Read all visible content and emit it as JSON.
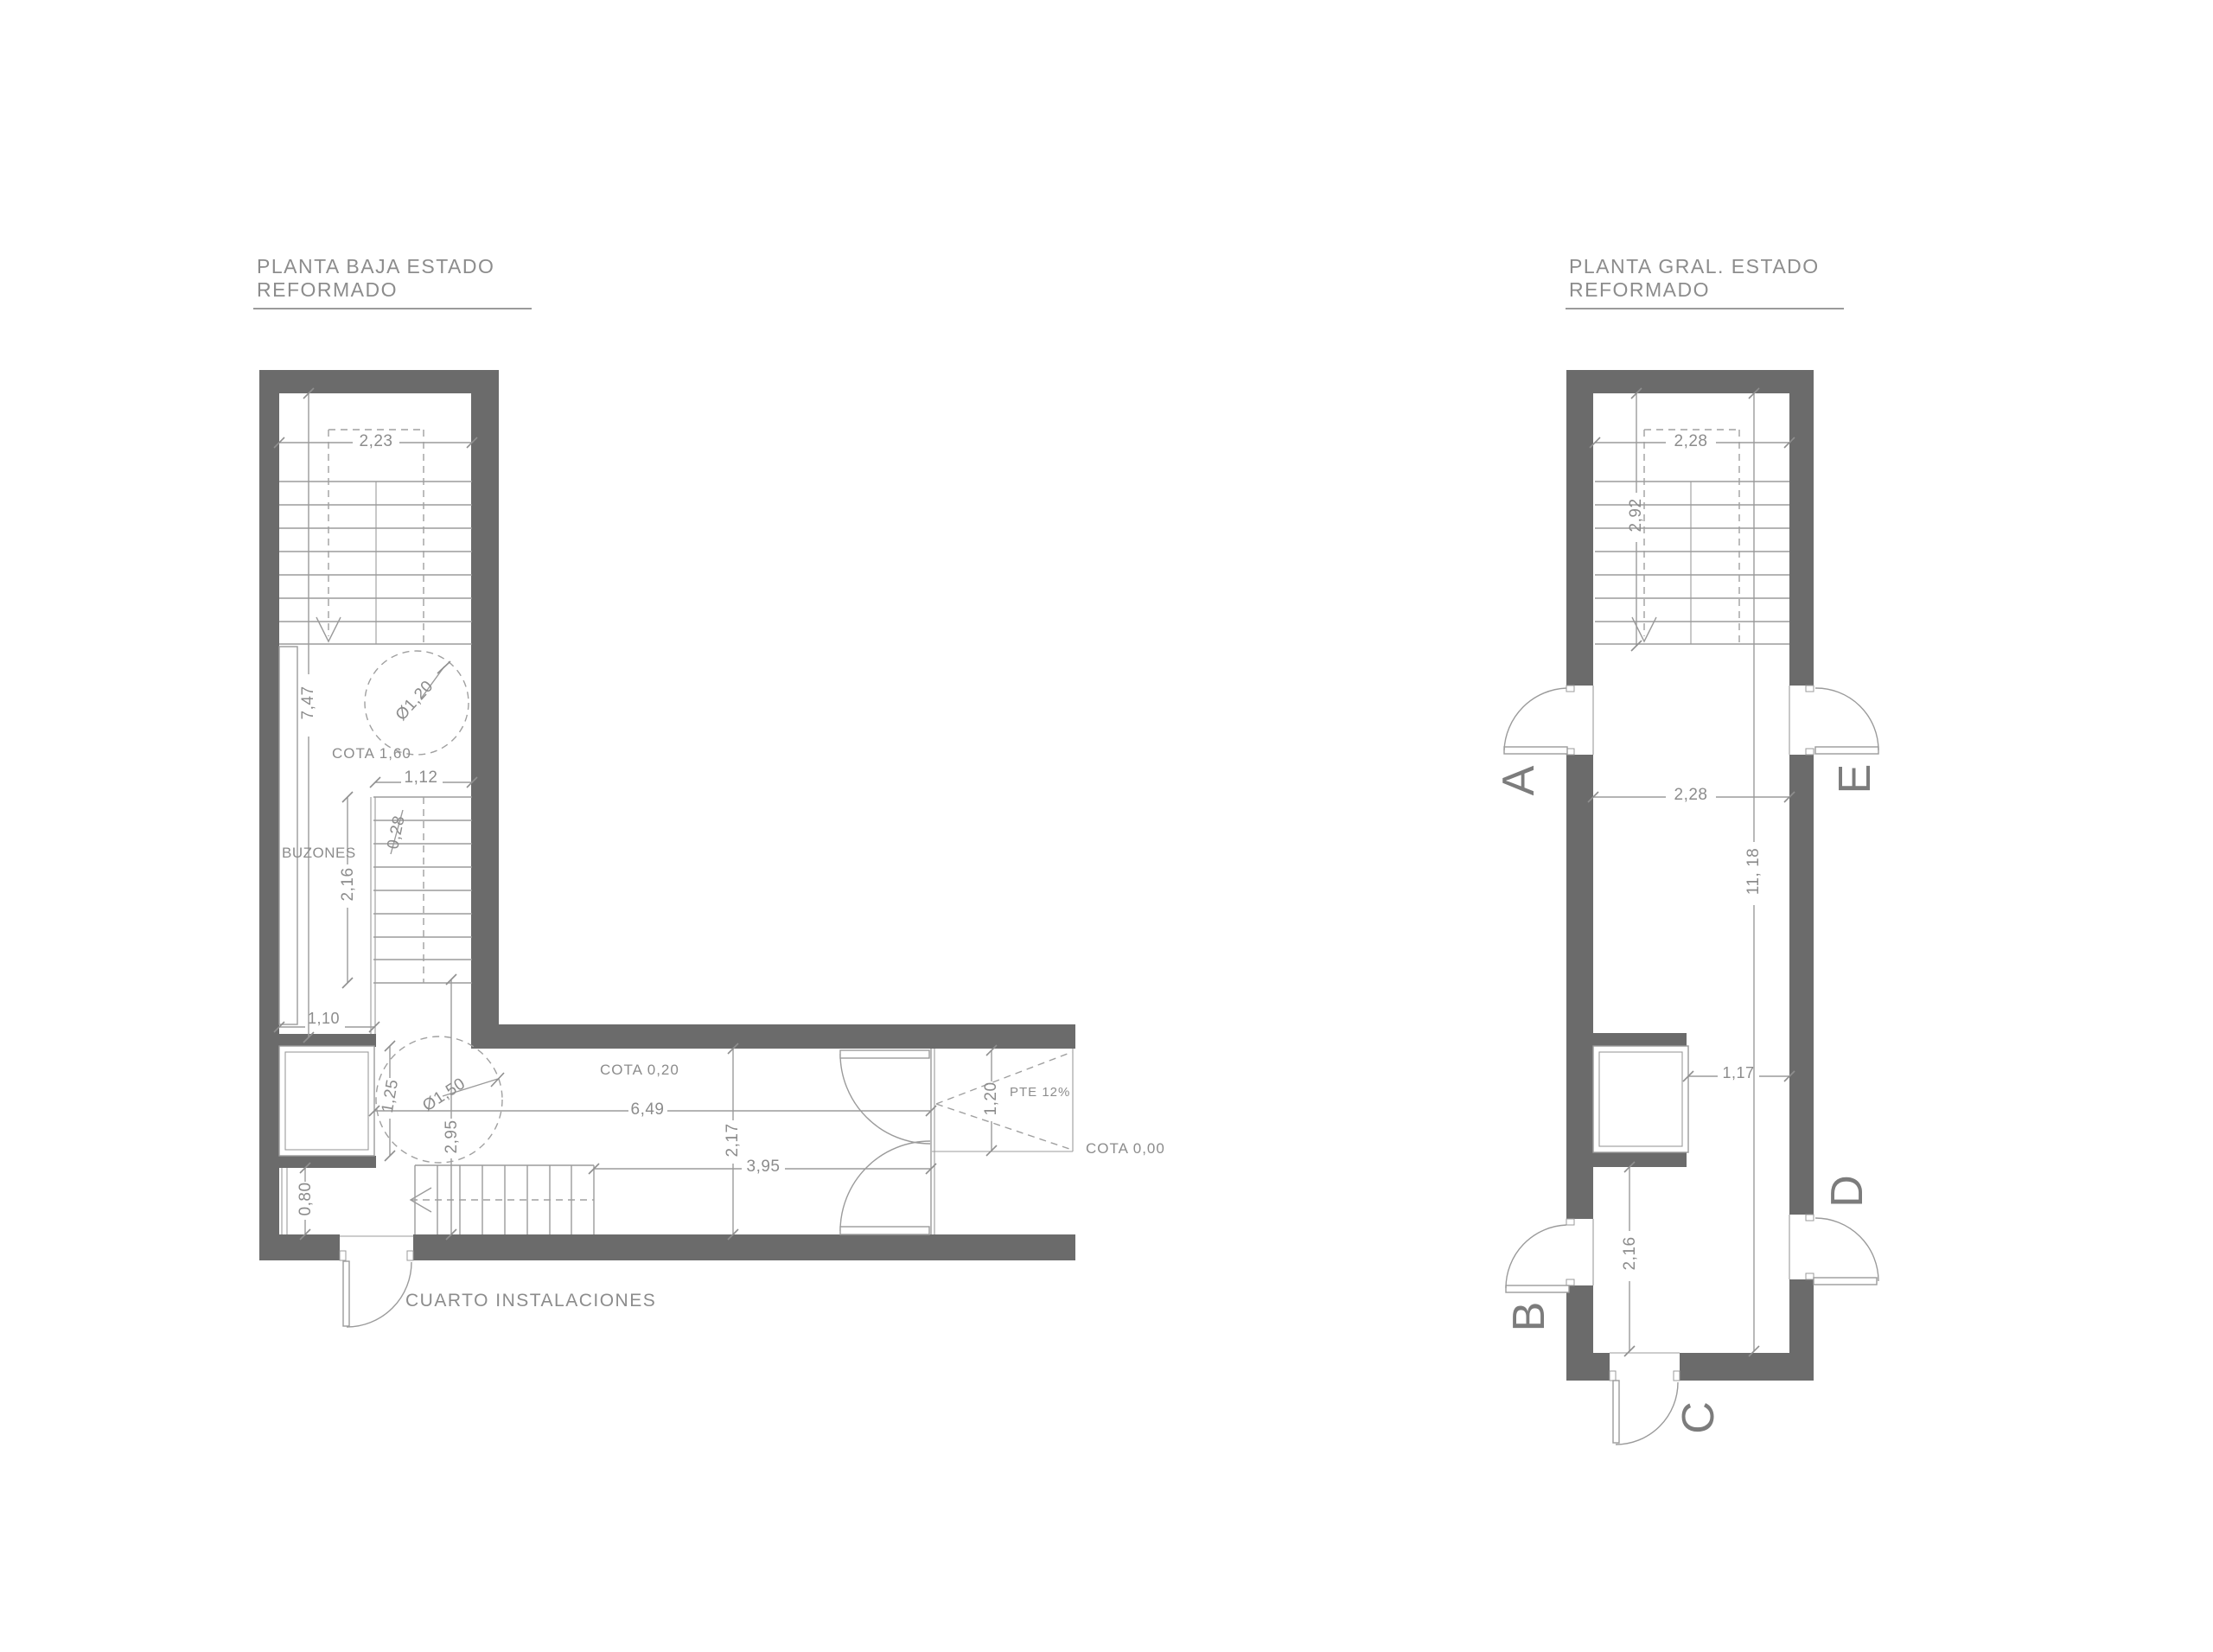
{
  "colors": {
    "background": "#ffffff",
    "wall_fill": "#6b6b6b",
    "thin_line": "#9b9b9b",
    "dashed_line": "#a0a0a0",
    "annotation_text": "#8c8c8c",
    "section_letter": "#7c7c7c"
  },
  "plans": {
    "left": {
      "title_line1": "PLANTA BAJA ESTADO",
      "title_line2": "REFORMADO",
      "labels": {
        "dim_width_top": "2,23",
        "dim_hall_length": "7,47",
        "dia_circle_upper": "Ø1,20",
        "cota_160": "COTA 1,60",
        "dim_stair_width": "1,12",
        "dim_tread": "0,28",
        "buzones": "BUZONES",
        "dim_flight": "2,16",
        "dim_passage": "1,10",
        "dim_shaft_front": "1,25",
        "dia_circle_lower": "Ø1,50",
        "dim_corridor_left": "2,95",
        "dim_room": "0,80",
        "cota_020": "COTA 0,20",
        "dim_corridor_length": "6,49",
        "dim_corridor_width": "2,17",
        "dim_door_to_stair": "3,95",
        "dim_ramp_width": "1,20",
        "ramp_slope": "PTE 12%",
        "cota_000": "COTA 0,00",
        "room_name": "CUARTO INSTALACIONES"
      }
    },
    "right": {
      "title_line1": "PLANTA GRAL. ESTADO",
      "title_line2": "REFORMADO",
      "labels": {
        "dim_width_top": "2,28",
        "dim_upper_flight": "2,92",
        "dim_width_mid": "2,28",
        "dim_total_length": "11, 18",
        "dim_shaft_front": "1,17",
        "dim_lower": "2,16",
        "section_a": "A",
        "section_b": "B",
        "section_c": "C",
        "section_d": "D",
        "section_e": "E"
      }
    }
  }
}
